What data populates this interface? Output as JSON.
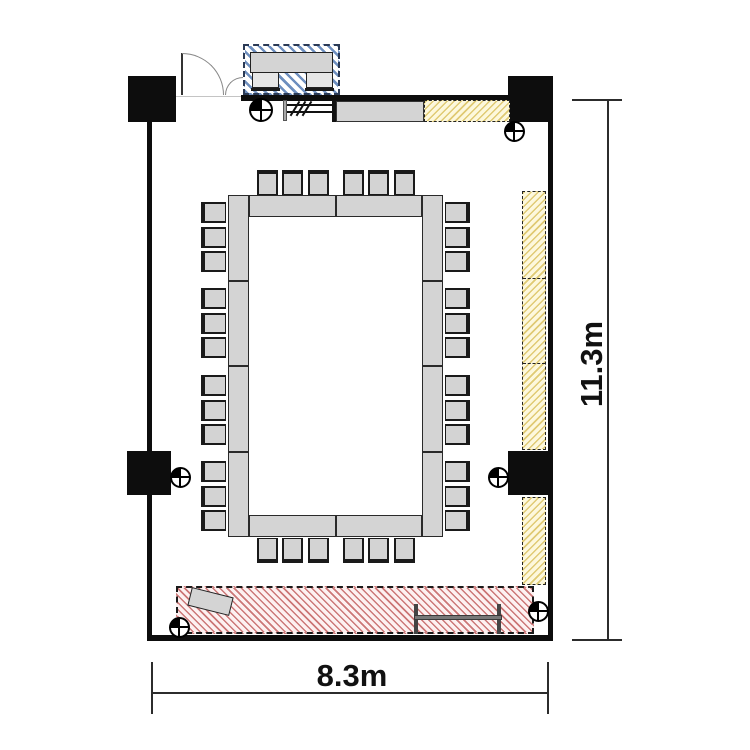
{
  "title": "Conference room floor plan",
  "dimension_labels": {
    "width": "8.3m",
    "height": "11.3m"
  },
  "colors": {
    "wall": "#0d0d0d",
    "outline": "#1a1a1a",
    "table_fill": "#d4d4d4",
    "chair_fill": "#d3d3d3",
    "reception_hatch": "#6e8fbf",
    "reception_border": "#2b3a55",
    "storage_fill": "#fdf8dd",
    "storage_hatch": "#e0ca74",
    "stage_fill": "#fdf1f1",
    "stage_hatch": "#cc7777",
    "dimension_text": "#111111"
  },
  "seating": {
    "top": {
      "groups": 2,
      "per_group": 3
    },
    "bottom": {
      "groups": 2,
      "per_group": 3
    },
    "left": {
      "groups": 4,
      "per_group": 3
    },
    "right": {
      "groups": 4,
      "per_group": 3
    },
    "total_chairs": 36,
    "reception_chairs": 2
  }
}
